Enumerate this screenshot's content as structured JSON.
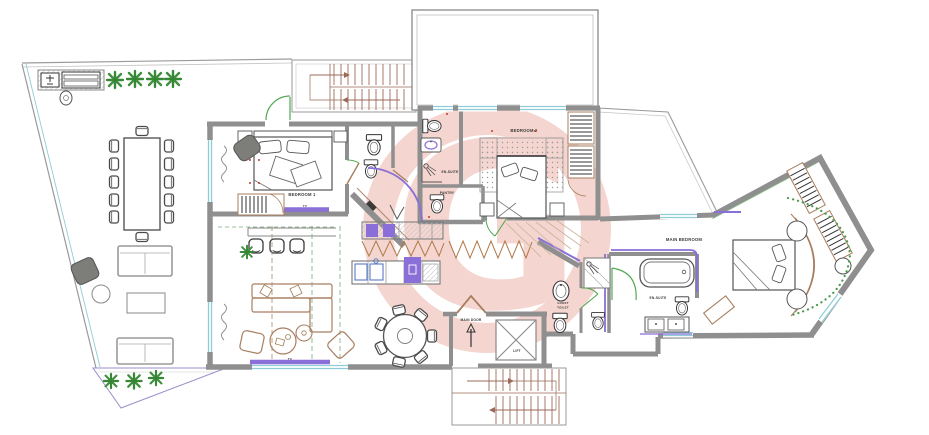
{
  "watermark": {
    "letter": "G"
  },
  "colors": {
    "watermark": "#d96a58",
    "wall": "#8f8f8f",
    "window": "#8ecdd8",
    "door_green": "#52a852",
    "plumbing_accent": "#8a6fd8",
    "furniture_brown": "#a87e5f",
    "stairs_brown": "#9b6a58",
    "plant_green": "#3f8f3f",
    "marker_red": "#c0392b",
    "label_text": "#3a3a3a"
  },
  "labels": {
    "bedroom1": "BEDROOM 1",
    "bedroom1_tv": "TV",
    "living_tv": "TV",
    "bedroom2": "BEDROOM 2",
    "ensuite2": "EN-SUITE",
    "pantry": "PANTRY",
    "main_bedroom": "MAIN BEDROOM",
    "main_ensuite": "EN-SUITE",
    "guest_toilet_line1": "GUEST",
    "guest_toilet_line2": "TOILET",
    "main_door": "MAIN DOOR",
    "lift": "LIFT"
  }
}
